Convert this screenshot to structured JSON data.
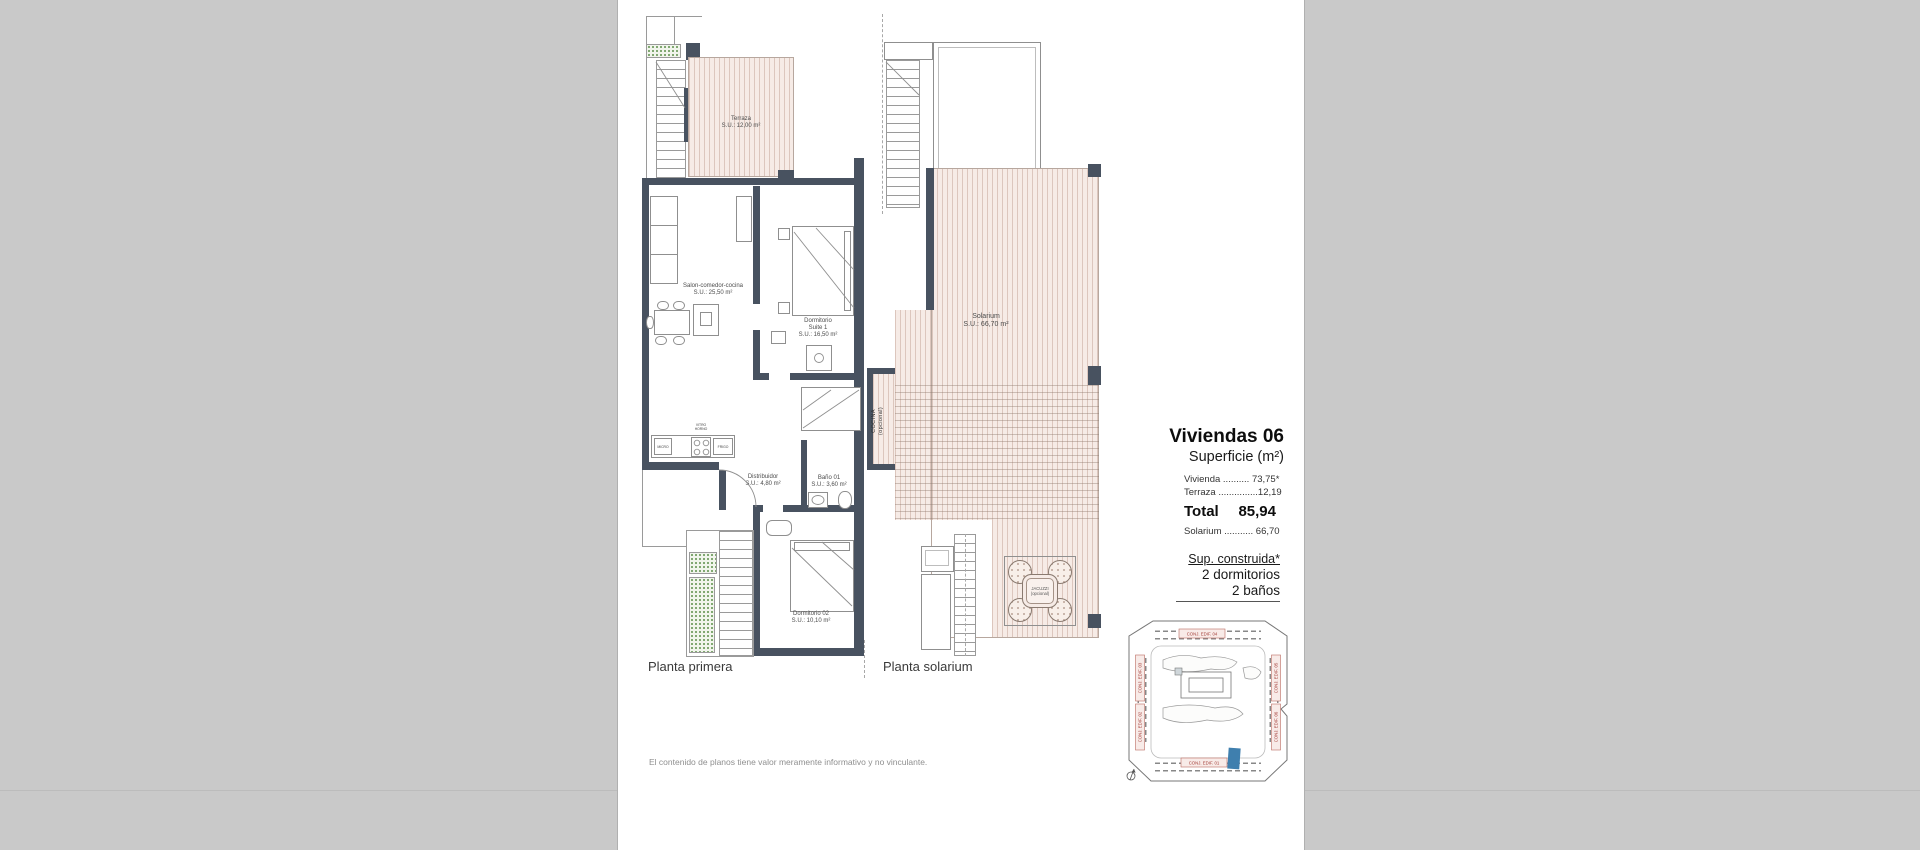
{
  "plan_primera": {
    "title": "Planta primera",
    "terraza_name": "Terraza",
    "terraza_area": "S.U.: 12,00 m²",
    "salon_name": "Salon-comedor-cocina",
    "salon_area": "S.U.: 25,50 m²",
    "suite_line1": "Dormitorio",
    "suite_line2": "Suite 1",
    "suite_area": "S.U.: 16,50 m²",
    "distribuidor_name": "Distribuidor",
    "distribuidor_area": "S.U.: 4,80 m²",
    "bano_name": "Baño 01",
    "bano_area": "S.U.: 3,60 m²",
    "dorm02_name": "Dormitorio 02",
    "dorm02_area": "S.U.: 10,10 m²",
    "kitchen": {
      "micro": "MICRO",
      "vitro_line1": "VITRO",
      "vitro_line2": "HORNO",
      "frigo": "FRIGO"
    }
  },
  "plan_solarium": {
    "title": "Planta solarium",
    "solarium_name": "Solarium",
    "solarium_area": "S.U.: 66,70 m²",
    "cocina_line1": "COCINA",
    "cocina_line2": "(opcional)",
    "jacuzzi_line1": "JACUZZI",
    "jacuzzi_line2": "(opcional)"
  },
  "info": {
    "title": "Viviendas 06",
    "subtitle": "Superficie (m²)",
    "row_vivienda": "Vivienda .......... 73,75*",
    "row_terraza": "Terraza ...............12,19",
    "total_label": "Total",
    "total_value": "85,94",
    "row_solarium": "Solarium ........... 66,70",
    "sup_construida": "Sup. construida*",
    "bedrooms": "2 dormitorios",
    "bathrooms": "2 baños"
  },
  "site_plan": {
    "edif_01": "CONJ. EDIF. 01",
    "edif_02": "CONJ. EDIF. 02",
    "edif_03": "CONJ. EDIF. 03",
    "edif_04": "CONJ. EDIF. 04",
    "edif_05": "CONJ. EDIF. 05",
    "edif_06": "CONJ. EDIF. 06",
    "highlight_color": "#3f7fae"
  },
  "footer": {
    "disclaimer": "El contenido de planos tiene valor meramente informativo y no vinculante."
  },
  "colors": {
    "wall": "#485260",
    "stripe_fill": "#f6ebe6",
    "stripe_line": "#dcc6bd",
    "background": "#c9c9c9",
    "site_red": "#a23b35"
  }
}
